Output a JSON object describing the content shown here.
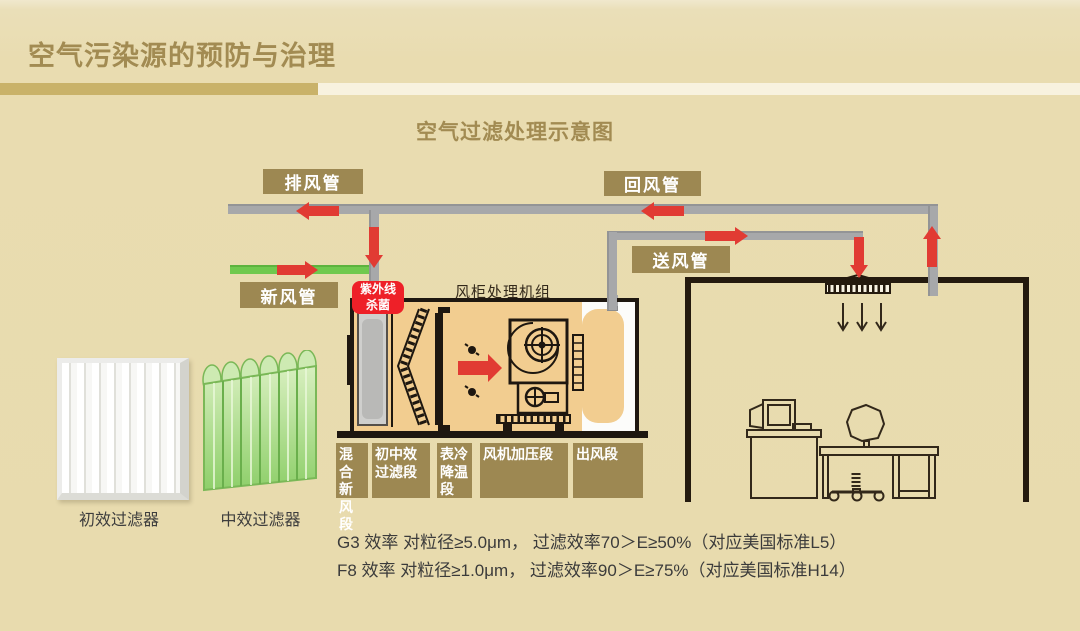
{
  "page": {
    "title": "空气污染源的预防与治理",
    "diagram_title": "空气过滤处理示意图"
  },
  "palette": {
    "background": "#e9dcb0",
    "accent_gold_dark": "#9d8852",
    "accent_gold_bar": "#c9b269",
    "bar_cream": "#f8f2df",
    "title_gold": "#a28b52",
    "flow_red": "#e13b33",
    "uv_red": "#ee2028",
    "pipe_gray": "#a7a8aa",
    "fresh_air_green": "#70c94e",
    "outline_black": "#1e1710",
    "ahu_fill_tan": "#f2cd90"
  },
  "duct_labels": {
    "exhaust": "排风管",
    "return": "回风管",
    "fresh": "新风管",
    "supply": "送风管"
  },
  "uv": {
    "label": "紫外线\n杀菌"
  },
  "ahu": {
    "title": "风柜处理机组",
    "sections": [
      {
        "label": "混合\n新风\n段"
      },
      {
        "label": "初中效\n过滤段"
      },
      {
        "label": "表冷\n降温\n段"
      },
      {
        "label": "风机加压段"
      },
      {
        "label": "出风段"
      }
    ]
  },
  "filters": [
    {
      "label": "初效过滤器"
    },
    {
      "label": "中效过滤器"
    }
  ],
  "notes": [
    "G3 效率 对粒径≥5.0μm， 过滤效率70＞E≥50%（对应美国标准L5）",
    "F8 效率 对粒径≥1.0μm， 过滤效率90＞E≥75%（对应美国标准H14）"
  ]
}
